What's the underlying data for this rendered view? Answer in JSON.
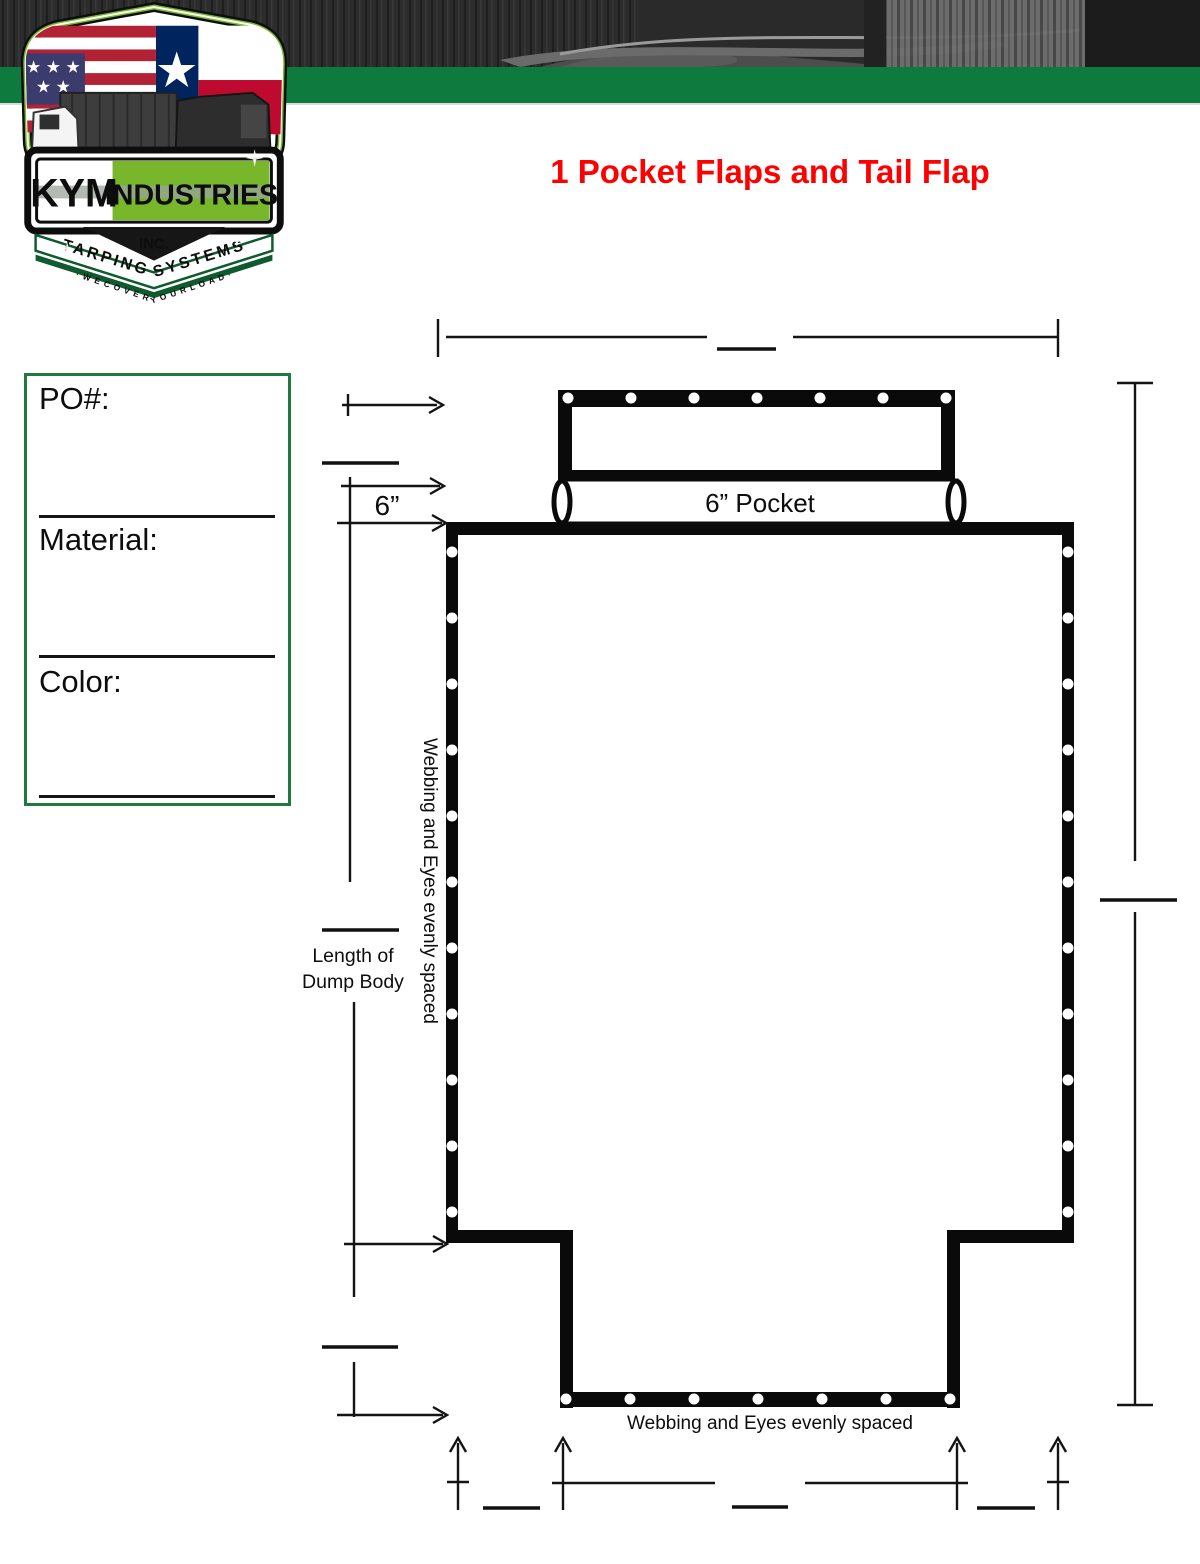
{
  "header": {
    "title": "1 Pocket Flaps and Tail Flap",
    "title_color": "#ff0000",
    "green_bar_color": "#0f7a3e"
  },
  "logo": {
    "kym": "KYM",
    "industries": "INDUSTRIES",
    "inc": "INC.",
    "band": "TARPING SYSTEMS",
    "motto": "· W E   C O V E R   Y O U R   L O A D ·",
    "lime_color": "#78b62c",
    "dark_green_color": "#0f5a2e"
  },
  "order_form": {
    "po_label": "PO#:",
    "material_label": "Material:",
    "color_label": "Color:",
    "border_color": "#1e7a3e"
  },
  "diagram": {
    "pocket_label": "6” Pocket",
    "six_inch_label": "6”",
    "length_label_line1": "Length of",
    "length_label_line2": "Dump Body",
    "webbing_left_label": "Webbing and Eyes evenly spaced",
    "webbing_bottom_label": "Webbing and Eyes evenly spaced",
    "line_color": "#141414",
    "grommets": {
      "top_flap": {
        "count": 7,
        "y": 398,
        "x_start": 568,
        "x_end": 946,
        "r": 5.5
      },
      "bottom_flap": {
        "count": 7,
        "y": 1399,
        "x_start": 566,
        "x_end": 950,
        "r": 5.5
      },
      "left_side": {
        "count": 11,
        "x": 452,
        "y_start": 552,
        "y_end": 1212,
        "r": 5.5
      },
      "right_side": {
        "count": 11,
        "x": 1068,
        "y_start": 552,
        "y_end": 1212,
        "r": 5.5
      }
    }
  }
}
